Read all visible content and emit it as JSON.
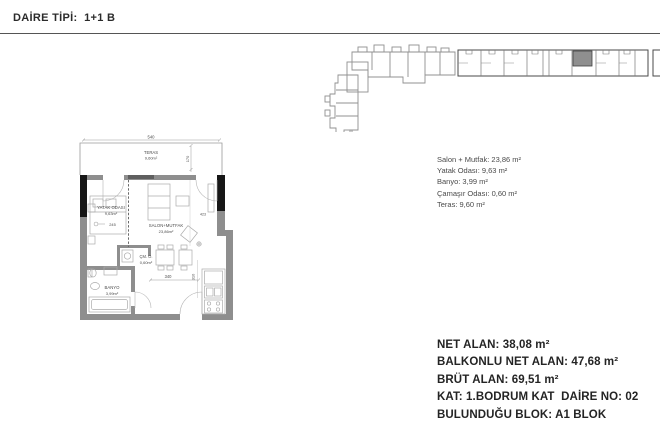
{
  "title": "DAİRE TİPİ:  1+1 B",
  "rooms": {
    "lines": [
      "Salon + Mutfak: 23,86 m²",
      "Yatak Odası: 9,63 m²",
      "Banyo: 3,99 m²",
      "Çamaşır Odası: 0,60 m²",
      "Teras: 9,60 m²"
    ]
  },
  "summary": {
    "lines": [
      "NET ALAN: 38,08 m²",
      "BALKONLU NET ALAN: 47,68 m²",
      "BRÜT ALAN: 69,51 m²",
      "KAT: 1.BODRUM KAT  DAİRE NO: 02",
      "BULUNDUĞU BLOK: A1 BLOK"
    ]
  },
  "plan": {
    "teras": {
      "name": "TERAS",
      "area": "9,60m²"
    },
    "yatak": {
      "name": "YATAK ODASI",
      "area": "9,63m²"
    },
    "salon": {
      "name": "SALON+MUTFAK",
      "area": "23,86m²"
    },
    "cmo": {
      "name": "ÇM. O.",
      "area": "0,60m²"
    },
    "banyo": {
      "name": "BANYO",
      "area": "3,99m²"
    },
    "dims": {
      "teras_width": "540",
      "teras_depth": "170",
      "yatak_width": "245",
      "salon_width": "423",
      "hall_width": "340",
      "kitchen_height": "310"
    }
  },
  "colors": {
    "wall": "#8e8e8e",
    "column": "#161616",
    "drawing_line": "#9a9a9a",
    "divider_rule": "#555555",
    "highlight_unit": "#8f8f8f",
    "text_dark": "#242424",
    "text_gray": "#4a4a4a"
  }
}
